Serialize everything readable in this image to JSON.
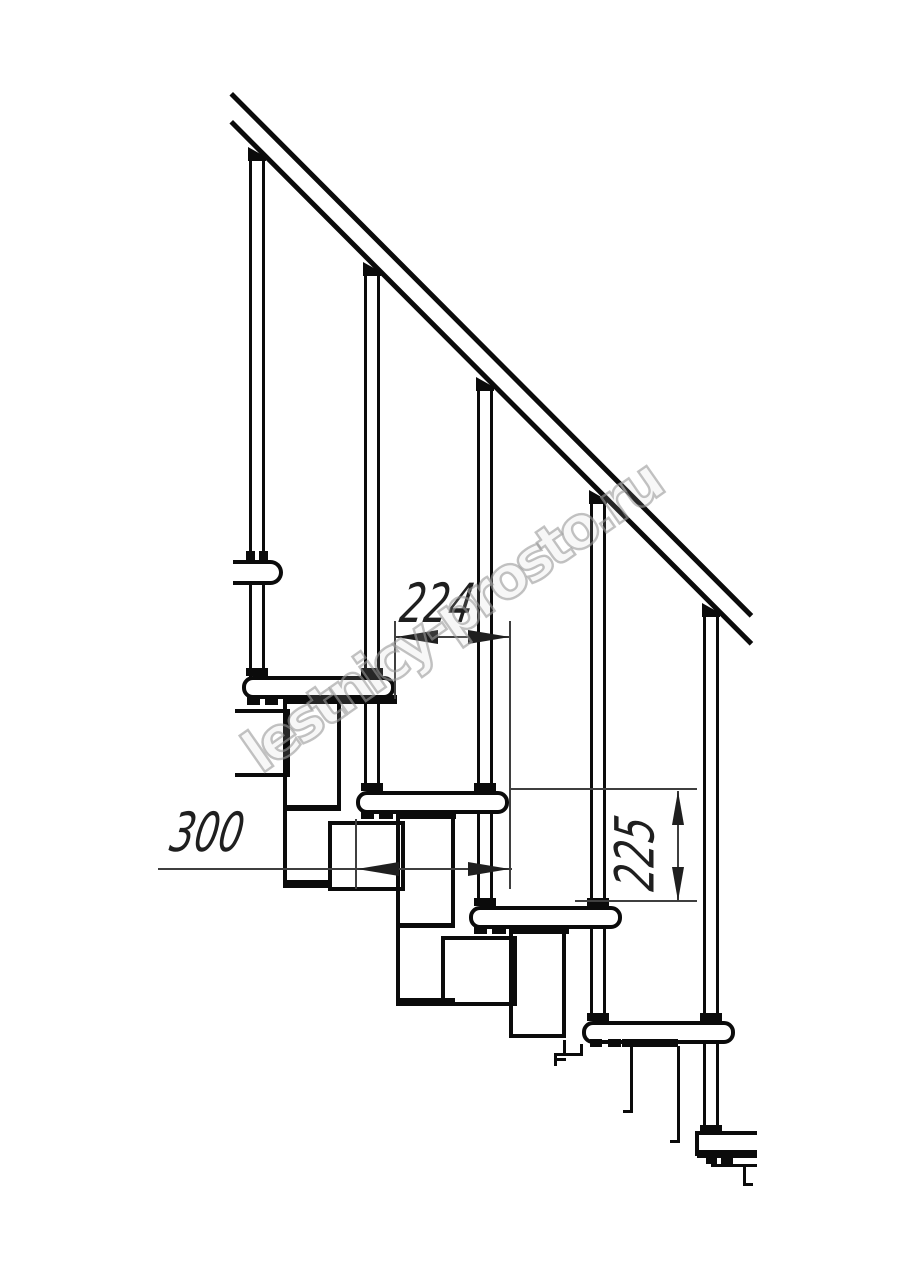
{
  "drawing": {
    "type": "staircase-side-elevation",
    "watermark": "lestnicy-prosto.ru",
    "dimensions": {
      "step_run": "224",
      "tread_depth": "300",
      "step_rise": "225"
    },
    "colors": {
      "line": "#0b0b0b",
      "dim": "#3f3f3f",
      "dim_text": "#1f1f1f",
      "watermark": "#9a9a9a",
      "bg": "#ffffff"
    }
  }
}
